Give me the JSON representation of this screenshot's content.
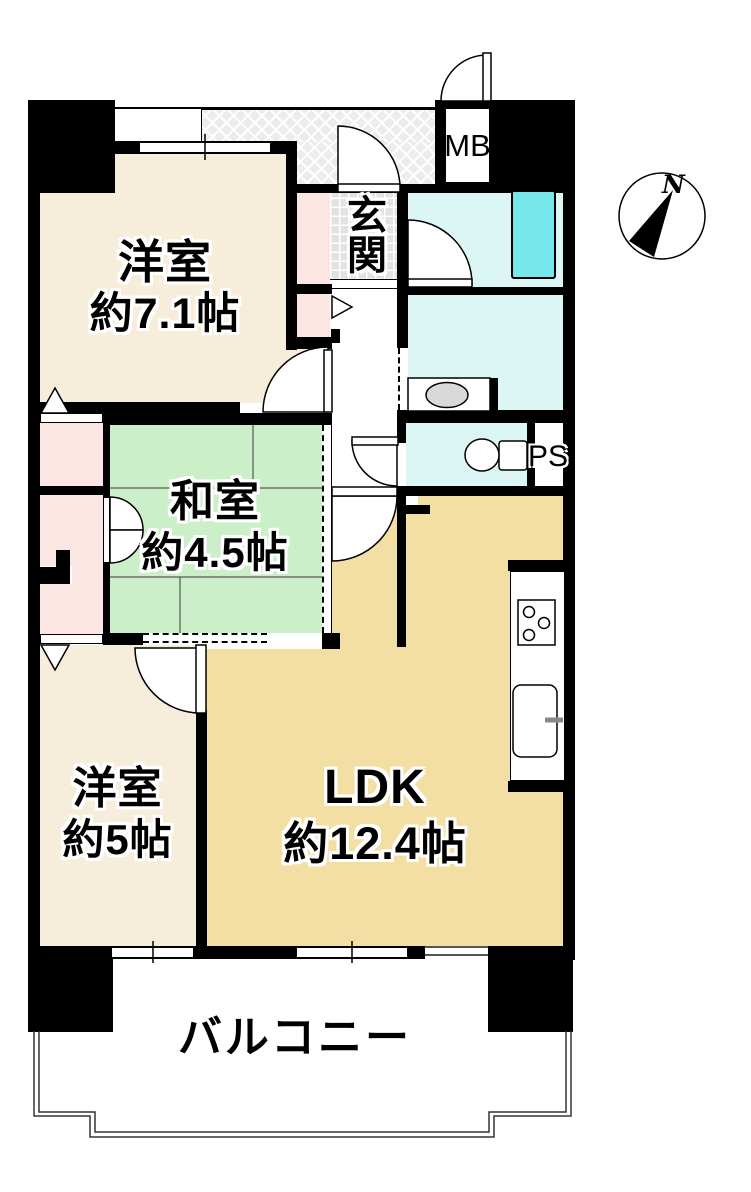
{
  "floor_plan": {
    "rooms": {
      "western1": {
        "name": "洋室",
        "size": "約7.1帖"
      },
      "japanese": {
        "name": "和室",
        "size": "約4.5帖"
      },
      "western2": {
        "name": "洋室",
        "size": "約5帖"
      },
      "ldk": {
        "name": "LDK",
        "size": "約12.4帖"
      }
    },
    "entrance_label": "玄関",
    "balcony_label": "バルコニー",
    "meter_box_label": "MB",
    "pipe_space_label": "PS",
    "compass_north_label": "N",
    "colors": {
      "wall": "#000000",
      "western_room": "#F6EEDB",
      "japanese_room": "#CBEFC8",
      "ldk": "#F3DFA4",
      "wet_area": "#DCF5F5",
      "bathtub": "#76E8EC",
      "closet_pink": "#FBE6E4",
      "entrance_tile": "#E2E2E2",
      "corridor_hatch": "#ECECEC"
    }
  }
}
